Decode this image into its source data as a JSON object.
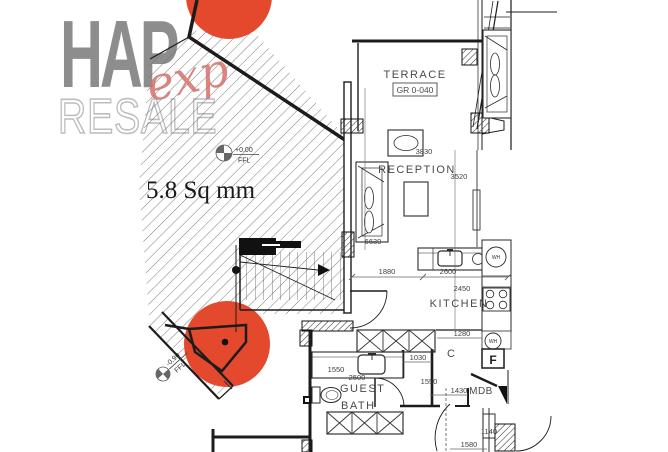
{
  "logo": {
    "word": "HAP",
    "script": "exp",
    "subtitle": "RESALE"
  },
  "plan": {
    "area_label": "5.8 Sq mm",
    "level_upper": {
      "value": "+0.00",
      "datum": "FFL"
    },
    "level_lower": {
      "value": "-0.90",
      "datum": "FFL"
    },
    "rooms": {
      "terrace": "TERRACE",
      "terrace_tag": "GR 0-040",
      "reception": "RECEPTION",
      "kitchen": "KITCHEN",
      "guest_bath": [
        "GUEST",
        "BATH"
      ]
    },
    "tags": {
      "mdb": "MDB",
      "fridge": "F",
      "water_heater": "WH",
      "door": "C"
    },
    "dims": {
      "d3830": "3830",
      "d3520": "3520",
      "d6630": "6630",
      "d1880": "1880",
      "d2600": "2600",
      "d2450": "2450",
      "d1280": "1280",
      "d1550_bath": "1550",
      "d2500": "2500",
      "d1030": "1030",
      "d1550_corr": "1550",
      "d1430": "1430",
      "d1140": "1140",
      "d1580": "1580"
    }
  },
  "colors": {
    "accent": "#E5492D",
    "logo_gray": "#8D8D8D",
    "logo_outline": "#BEBEBE",
    "script_red": "#D4716B",
    "line": "#1c1c1c"
  }
}
